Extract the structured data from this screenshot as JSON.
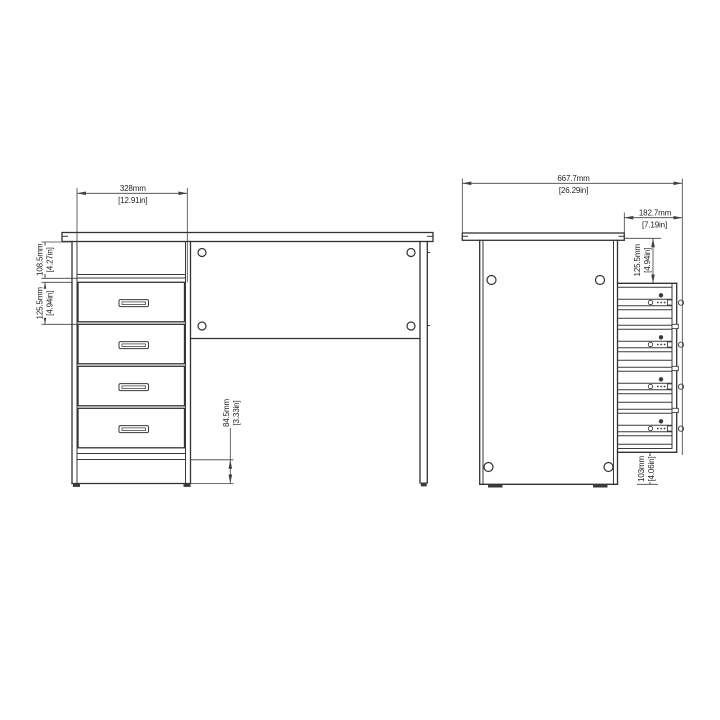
{
  "colors": {
    "background": "#ffffff",
    "part_line": "#333333",
    "dimension_line": "#404040",
    "text": "#1f1f1f"
  },
  "views": {
    "front": {
      "dims": {
        "width": {
          "mm": "328mm",
          "inches": "[12.91in]"
        },
        "top": {
          "mm": "108.5mm",
          "inches": "[4.27in]"
        },
        "drawer": {
          "mm": "125.5mm",
          "inches": "[4.94in]"
        },
        "plinth": {
          "mm": "84.5mm",
          "inches": "[3.33in]"
        }
      }
    },
    "side": {
      "dims": {
        "width": {
          "mm": "667.7mm",
          "inches": "[26.29in]"
        },
        "drawer_depth": {
          "mm": "182.7mm",
          "inches": "[7.19in]"
        },
        "top_offset": {
          "mm": "125.5mm",
          "inches": "[4.94in]"
        },
        "floor_gap": {
          "mm": "103mm",
          "inches": "[4.06in]"
        }
      }
    }
  }
}
